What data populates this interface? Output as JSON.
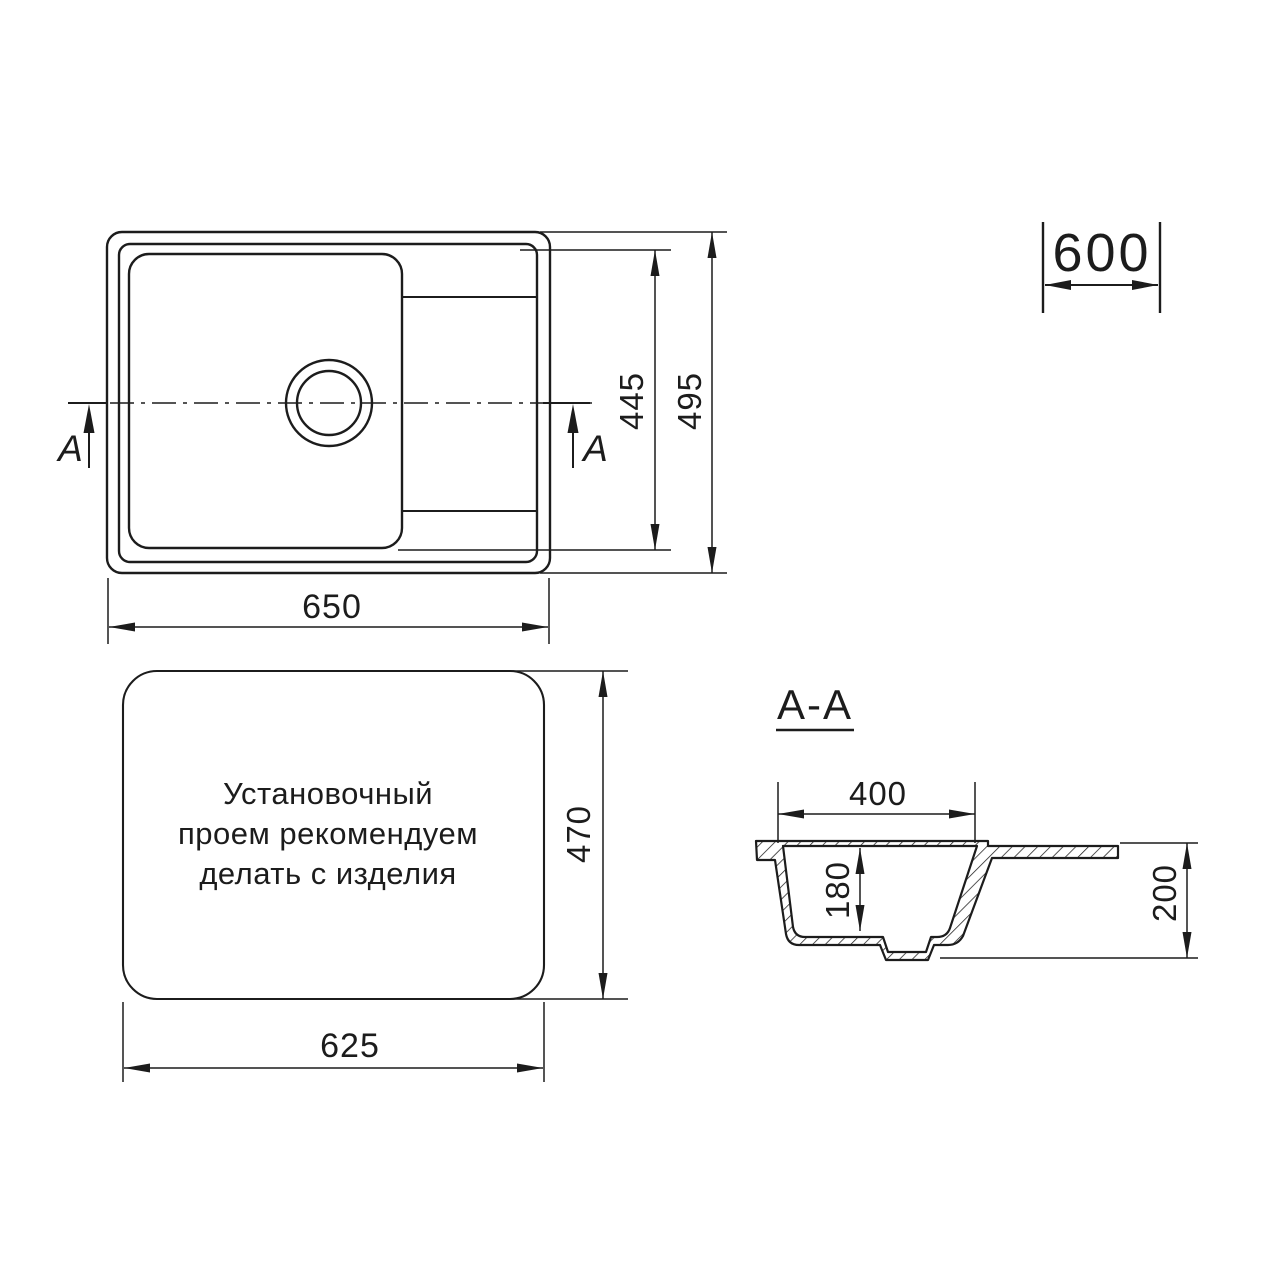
{
  "page": {
    "background": "#ffffff",
    "line_color": "#1c1c1c"
  },
  "views": {
    "top_view": {
      "dim_width": "650",
      "dim_bowl_height": "445",
      "dim_overall_height": "495",
      "section_marker_left": "A",
      "section_marker_right": "A"
    },
    "cabinet": {
      "dim_width": "600"
    },
    "install_view": {
      "note_lines": [
        "Установочный",
        "проем рекомендуем",
        "делать с изделия"
      ],
      "dim_height": "470",
      "dim_width": "625"
    },
    "section_view": {
      "title": "A-A",
      "dim_bowl_width": "400",
      "dim_bowl_depth": "180",
      "dim_overall_depth": "200"
    }
  }
}
